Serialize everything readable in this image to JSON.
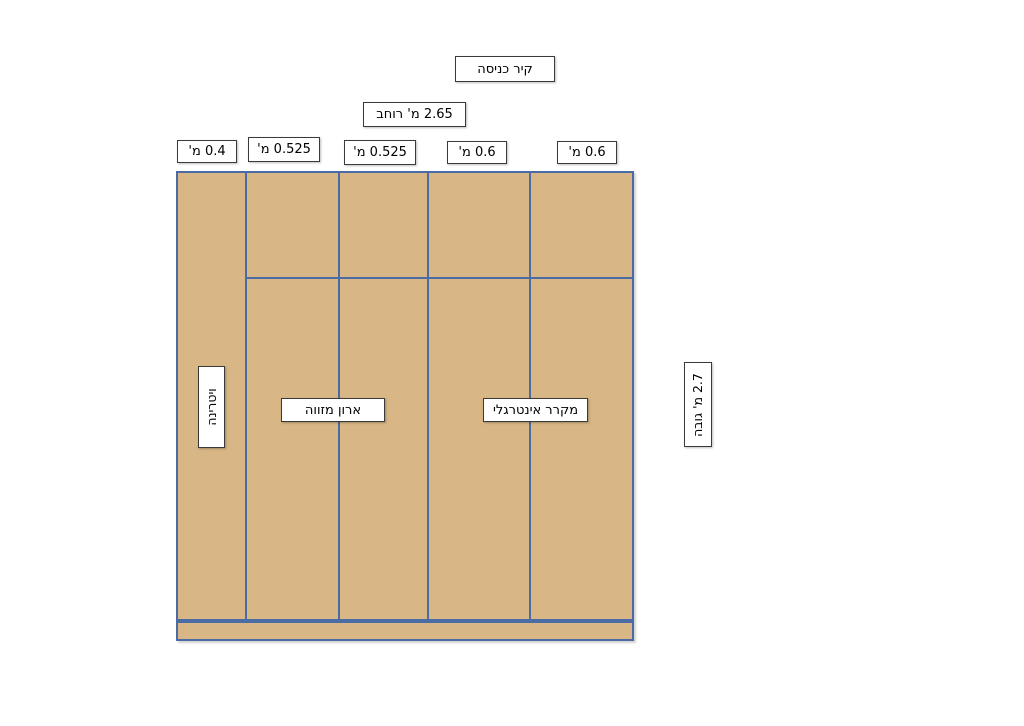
{
  "wall": {
    "entrance_label": "קיר כניסה"
  },
  "dimensions": {
    "total_width": "2.65 מ' רוחב",
    "total_height": "2.7 מ' גובה",
    "columns": [
      "0.4 מ'",
      "0.525 מ'",
      "0.525 מ'",
      "0.6 מ'",
      "0.6 מ'"
    ]
  },
  "sections": {
    "vitrine": "ויטרינה",
    "pantry_cabinet": "ארון מזווה",
    "integrated_fridge": "מקרר אינטרגלי"
  },
  "colors": {
    "cabinet_fill": "#d8b685",
    "cabinet_border": "#4a6ba4",
    "label_border": "#3a3a3a",
    "label_bg": "#ffffff"
  }
}
